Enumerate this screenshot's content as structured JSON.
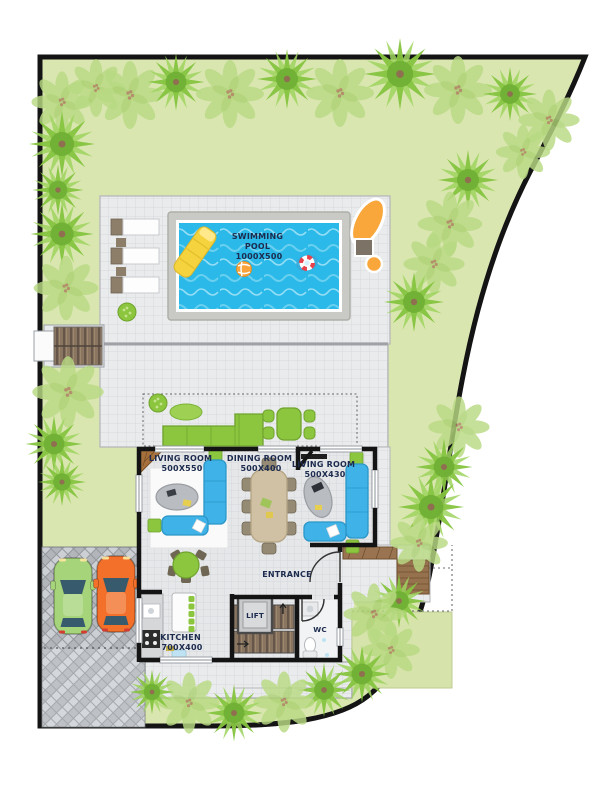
{
  "plan": {
    "type": "villa-site-floor-plan",
    "rooms": [
      {
        "id": "swimming-pool",
        "lines": [
          "SWIMMING",
          "POOL",
          "1000X500"
        ]
      },
      {
        "id": "living-room-left",
        "lines": [
          "LIVING ROOM",
          "500X550"
        ]
      },
      {
        "id": "dining-room",
        "lines": [
          "DINING ROOM",
          "500X400"
        ]
      },
      {
        "id": "living-room-right",
        "lines": [
          "LIVING ROOM",
          "500X430"
        ]
      },
      {
        "id": "entrance",
        "lines": [
          "ENTRANCE"
        ]
      },
      {
        "id": "lift",
        "lines": [
          "LIFT"
        ]
      },
      {
        "id": "kitchen",
        "lines": [
          "KITCHEN",
          "700X400"
        ]
      },
      {
        "id": "wc",
        "lines": [
          "WC"
        ]
      }
    ],
    "colors": {
      "lawn": "#d9e6b0",
      "tree_palm": "#86c440",
      "tree_leaf": "#b9da83",
      "paving": "#eaebed",
      "pool_water": "#2ab9e8",
      "pool_frame": "#c9cac5",
      "wall": "#141414",
      "sofa_blue": "#3fb3e8",
      "furniture_green": "#8cc63f",
      "dining_wood": "#d0c1a4",
      "stair_wood": "#7b6954",
      "car_green": "#a6d47a",
      "car_orange": "#f2702a",
      "lounger_orange": "#f9a63a",
      "driveway": "#94989c",
      "label_text": "#1c2b4e"
    }
  }
}
